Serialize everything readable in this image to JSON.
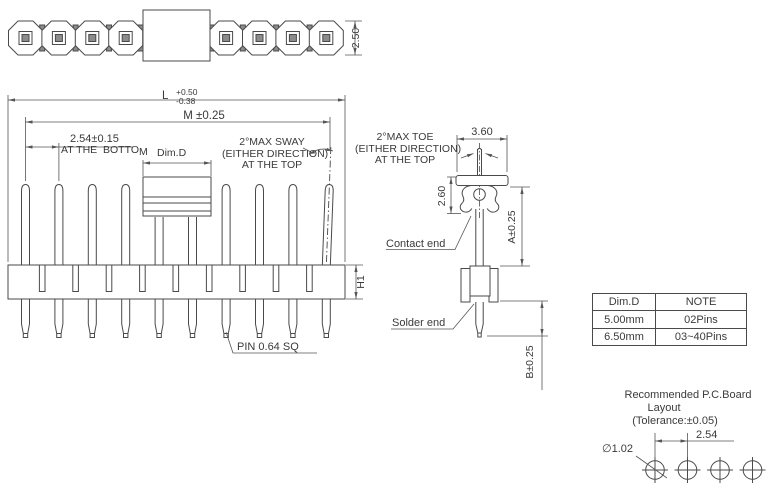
{
  "palette": {
    "line": "#4a4a4a",
    "text": "#3a3a3a",
    "metal_fill": "#8c8c8c"
  },
  "top_view": {
    "height_dim": "2.50"
  },
  "front_view": {
    "length_dim_label": "L",
    "length_tol_plus": "+0.50",
    "length_tol_minus": "-0.38",
    "overall_dim": "M ±0.25",
    "pitch_dim": "2.54±0.15",
    "pitch_note": "AT THE  BOTTO",
    "pitch_note_m": "M",
    "dim_d_label": "Dim.D",
    "sway_line1": "2°MAX SWAY",
    "sway_line2": "(EITHER DIRECTION)",
    "sway_line3": "AT THE TOP",
    "housing_height_dim": "H1",
    "pin_note": "PIN 0.64 SQ"
  },
  "detail_view": {
    "toe_line1": "2°MAX TOE",
    "toe_line2": "(EITHER DIRECTION)",
    "toe_line3": "AT THE TOP",
    "width_dim": "3.60",
    "contact_len_dim": "2.60",
    "above_board_dim": "A±0.25",
    "below_board_dim": "B±0.25",
    "contact_label": "Contact end",
    "solder_label": "Solder end"
  },
  "spec_table": {
    "headers": [
      "Dim.D",
      "NOTE"
    ],
    "rows": [
      [
        "5.00mm",
        "02Pins"
      ],
      [
        "6.50mm",
        "03~40Pins"
      ]
    ]
  },
  "pcb_layout": {
    "title_line1": "Recommended P.C.Board",
    "title_line2": "Layout",
    "title_line3": "(Tolerance:±0.05)",
    "pitch_dim": "2.54",
    "hole_dim": "∅1.02"
  }
}
